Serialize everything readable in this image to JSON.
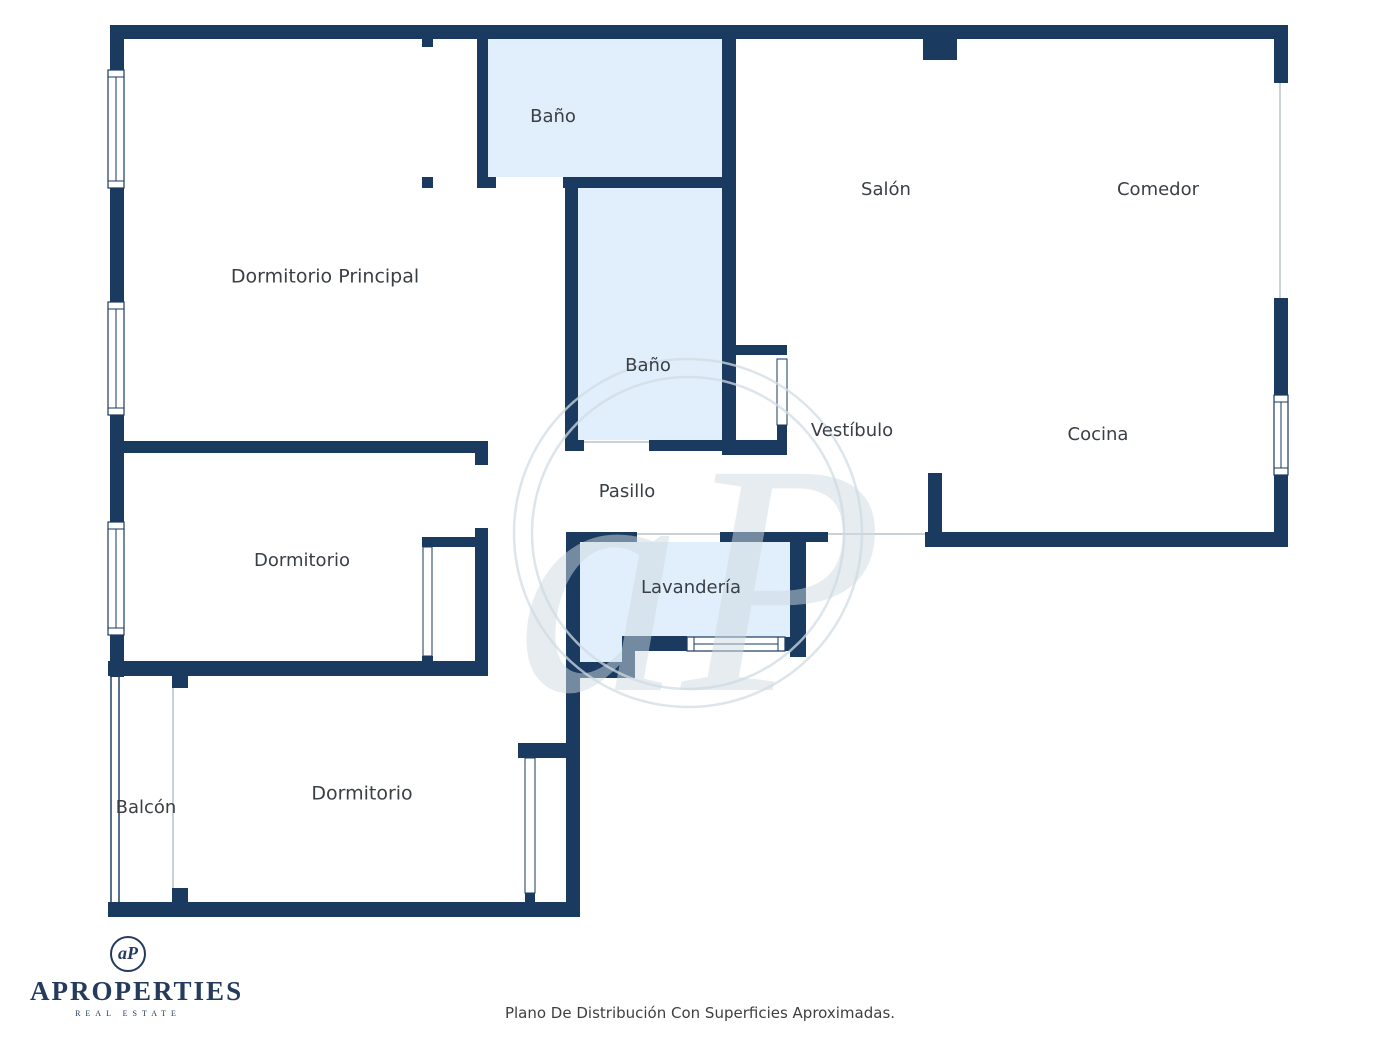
{
  "canvas": {
    "width": 1400,
    "height": 1050,
    "background": "#ffffff"
  },
  "colors": {
    "wall": "#1a3a5f",
    "room_fill": "#e0effb",
    "label_text": "#3a3f45",
    "thin_line": "#b9c3cc",
    "balcony_rail": "#2c4d75",
    "watermark_ring": "rgba(210,220,228,0.75)",
    "watermark_glyph": "rgba(205,217,226,0.50)"
  },
  "floor_plan": {
    "fills": [
      {
        "room": "bano-1",
        "x": 488,
        "y": 39,
        "w": 234,
        "h": 138
      },
      {
        "room": "bano-2",
        "x": 578,
        "y": 188,
        "w": 144,
        "h": 252
      },
      {
        "room": "lavanderia",
        "x": 580,
        "y": 542,
        "w": 210,
        "h": 95
      },
      {
        "room": "lavanderia-ext",
        "x": 580,
        "y": 637,
        "w": 42,
        "h": 25
      }
    ],
    "walls": [
      [
        110,
        25,
        1178,
        14
      ],
      [
        923,
        39,
        34,
        21
      ],
      [
        110,
        25,
        14,
        45
      ],
      [
        110,
        188,
        14,
        114
      ],
      [
        110,
        415,
        14,
        107
      ],
      [
        110,
        635,
        14,
        42
      ],
      [
        1274,
        25,
        14,
        58
      ],
      [
        1274,
        298,
        14,
        97
      ],
      [
        1274,
        475,
        14,
        72
      ],
      [
        925,
        532,
        363,
        15
      ],
      [
        928,
        473,
        14,
        62
      ],
      [
        722,
        39,
        14,
        416
      ],
      [
        422,
        39,
        11,
        8
      ],
      [
        477,
        39,
        11,
        149
      ],
      [
        422,
        177,
        11,
        11
      ],
      [
        477,
        177,
        19,
        11
      ],
      [
        563,
        177,
        159,
        11
      ],
      [
        565,
        188,
        13,
        252
      ],
      [
        565,
        440,
        19,
        11
      ],
      [
        649,
        440,
        73,
        11
      ],
      [
        722,
        345,
        65,
        10
      ],
      [
        777,
        425,
        10,
        30
      ],
      [
        722,
        440,
        65,
        15
      ],
      [
        110,
        441,
        378,
        12
      ],
      [
        475,
        441,
        13,
        24
      ],
      [
        475,
        528,
        13,
        145
      ],
      [
        422,
        537,
        55,
        10
      ],
      [
        422,
        656,
        11,
        17
      ],
      [
        108,
        661,
        380,
        15
      ],
      [
        172,
        676,
        16,
        12
      ],
      [
        172,
        888,
        16,
        14
      ],
      [
        566,
        532,
        71,
        10
      ],
      [
        720,
        532,
        108,
        10
      ],
      [
        790,
        532,
        16,
        125
      ],
      [
        785,
        637,
        21,
        14
      ],
      [
        622,
        636,
        65,
        15
      ],
      [
        622,
        650,
        13,
        28
      ],
      [
        580,
        662,
        55,
        16
      ],
      [
        566,
        542,
        14,
        120
      ],
      [
        566,
        662,
        14,
        255
      ],
      [
        518,
        743,
        48,
        15
      ],
      [
        525,
        893,
        10,
        14
      ],
      [
        108,
        902,
        470,
        15
      ]
    ],
    "windows": [
      {
        "x": 108,
        "y": 70,
        "w": 16,
        "h": 118,
        "dir": "v"
      },
      {
        "x": 108,
        "y": 302,
        "w": 16,
        "h": 113,
        "dir": "v"
      },
      {
        "x": 108,
        "y": 522,
        "w": 16,
        "h": 113,
        "dir": "v"
      },
      {
        "x": 1274,
        "y": 395,
        "w": 14,
        "h": 80,
        "dir": "v"
      },
      {
        "x": 687,
        "y": 637,
        "w": 98,
        "h": 14,
        "dir": "h"
      }
    ],
    "door_panels": [
      {
        "x": 423,
        "y": 547,
        "w": 9,
        "h": 109
      },
      {
        "x": 525,
        "y": 758,
        "w": 10,
        "h": 135
      },
      {
        "x": 777,
        "y": 359,
        "w": 10,
        "h": 66
      }
    ],
    "thin_lines": [
      {
        "x1": 1280,
        "y1": 83,
        "x2": 1280,
        "y2": 298
      },
      {
        "x1": 584,
        "y1": 442,
        "x2": 649,
        "y2": 442
      },
      {
        "x1": 637,
        "y1": 534,
        "x2": 720,
        "y2": 534
      },
      {
        "x1": 828,
        "y1": 534,
        "x2": 925,
        "y2": 534
      },
      {
        "x1": 173,
        "y1": 688,
        "x2": 173,
        "y2": 888
      }
    ],
    "balcony_rails": [
      {
        "x1": 111,
        "y1": 677,
        "x2": 111,
        "y2": 902
      },
      {
        "x1": 119,
        "y1": 677,
        "x2": 119,
        "y2": 902
      }
    ],
    "labels": [
      {
        "text": "Baño",
        "x": 553,
        "y": 117,
        "size": 18
      },
      {
        "text": "Salón",
        "x": 886,
        "y": 190,
        "size": 18
      },
      {
        "text": "Comedor",
        "x": 1158,
        "y": 190,
        "size": 18
      },
      {
        "text": "Dormitorio Principal",
        "x": 325,
        "y": 277,
        "size": 19
      },
      {
        "text": "Baño",
        "x": 648,
        "y": 366,
        "size": 18
      },
      {
        "text": "Vestíbulo",
        "x": 852,
        "y": 431,
        "size": 18
      },
      {
        "text": "Cocina",
        "x": 1098,
        "y": 435,
        "size": 18
      },
      {
        "text": "Pasillo",
        "x": 627,
        "y": 492,
        "size": 18
      },
      {
        "text": "Dormitorio",
        "x": 302,
        "y": 561,
        "size": 18
      },
      {
        "text": "Lavandería",
        "x": 691,
        "y": 588,
        "size": 18
      },
      {
        "text": "Dormitorio",
        "x": 362,
        "y": 794,
        "size": 19
      },
      {
        "text": "Balcón",
        "x": 146,
        "y": 808,
        "size": 18
      }
    ],
    "watermark": {
      "cx": 688,
      "cy": 533,
      "r_outer": 174,
      "r_inner": 156,
      "monogram": "aP",
      "font_size": 330,
      "text_x": 700,
      "text_y": 690
    }
  },
  "footer": {
    "logo": {
      "monogram": "aP",
      "brand": "APROPERTIES",
      "tagline": "REAL ESTATE"
    },
    "caption": "Plano De Distribución Con Superficies Aproximadas."
  }
}
